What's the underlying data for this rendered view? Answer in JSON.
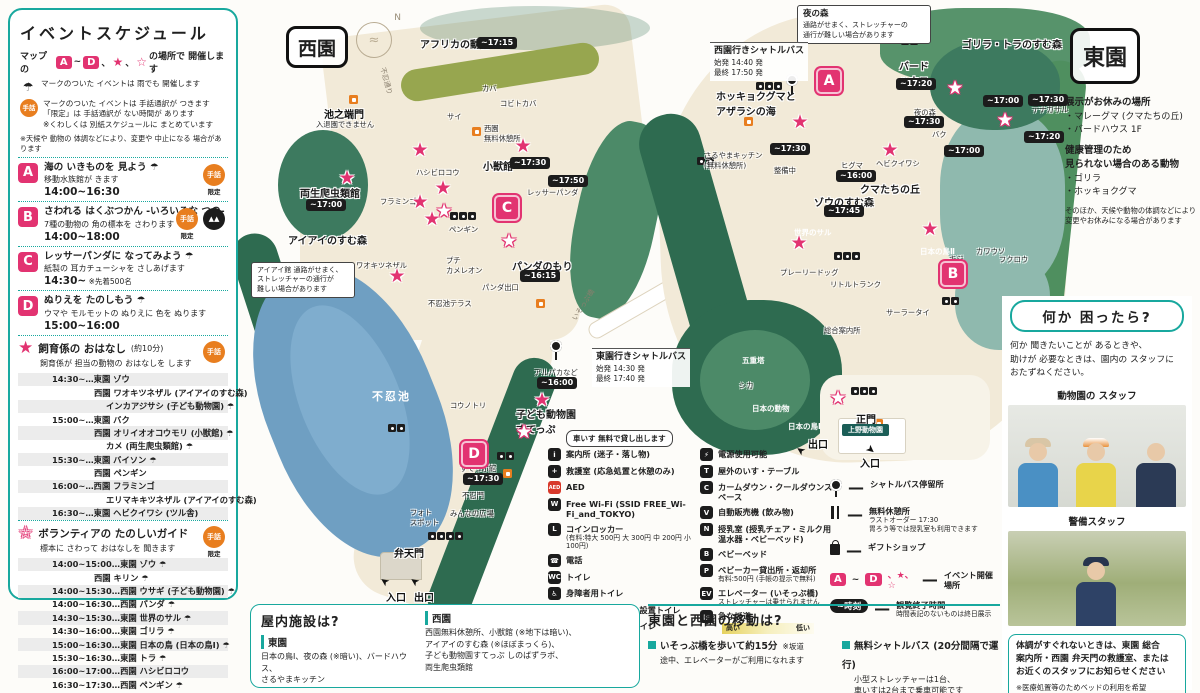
{
  "colors": {
    "teal": "#18a89e",
    "pink": "#e23371",
    "orange": "#e87e1f",
    "chip": "#1c1c1c",
    "pond": "#6f9fc2"
  },
  "icons": {
    "umbrella": "☂",
    "sign": "手話",
    "limited": "限定",
    "star": "★",
    "open_star": "☆",
    "north": "N"
  },
  "left_panel": {
    "title": "イベントスケジュール",
    "intro": {
      "pre": "マップの",
      "a": "A",
      "tilde": "~",
      "d": "D",
      "c1": "、",
      "star": "★",
      "c2": "、",
      "ostar": "☆",
      "post": "の場所で 開催します"
    },
    "note_umbrella": "マークのついた イベントは 雨でも 開催します",
    "note_sign": "マークのついた イベントは 手話通訳が つきます\n「限定」は 手話通訳が ない時間が あります\n※くわしくは 別紙スケジュールに まとめています",
    "disclaimer": "※天候や 動物の 体調などにより、変更や 中止になる 場合があります",
    "events": [
      {
        "letter": "A",
        "title": "海の いきものを 見よう ☂",
        "desc": "移動水族館が きます",
        "time": "14:00~16:30",
        "extra": "",
        "icons": [
          "sign-limited"
        ]
      },
      {
        "letter": "B",
        "title": "さわれる はくぶつかん -いろいろな つの-",
        "desc": "7種の動物の 角の標本を さわります ☂",
        "time": "14:00~18:00",
        "extra": "",
        "icons": [
          "sign-limited",
          "horn-pin"
        ]
      },
      {
        "letter": "C",
        "title": "レッサーパンダに なってみよう ☂",
        "desc": "紙製の 耳カチューシャを さしあげます",
        "time": "14:30~",
        "extra": "※先着500名",
        "icons": []
      },
      {
        "letter": "D",
        "title": "ぬりえを たのしもう ☂",
        "desc": "ウマや モルモットの ぬりえに 色を ぬります",
        "time": "15:00~16:00",
        "extra": "",
        "icons": []
      }
    ],
    "star_section": {
      "glyph": "★",
      "title": "飼育係の おはなし",
      "dur": "(約10分)",
      "desc": "飼育係が 担当の動物の おはなしを します",
      "rows": [
        {
          "t": "14:30~…東園 ゾウ",
          "i": 0
        },
        {
          "t": "西園 ワオキツネザル (アイアイのすむ森)",
          "i": 1
        },
        {
          "t": "インカアジサシ (子ども動物園) ☂",
          "i": 2
        },
        {
          "t": "15:00~…東園 バク",
          "i": 0
        },
        {
          "t": "西園 オリイオオコウモリ (小獣館) ☂",
          "i": 1
        },
        {
          "t": "カメ (両生爬虫類館) ☂",
          "i": 2
        },
        {
          "t": "15:30~…東園 バイソン ☂",
          "i": 0
        },
        {
          "t": "西園 ペンギン",
          "i": 1
        },
        {
          "t": "16:00~…西園 フラミンゴ",
          "i": 0
        },
        {
          "t": "エリマキキツネザル (アイアイのすむ森)",
          "i": 2
        },
        {
          "t": "16:30~…東園 ヘビクイワシ (ツル舎)",
          "i": 0
        }
      ]
    },
    "open_section": {
      "glyph": "☆",
      "title": "ボランティアの たのしいガイド",
      "desc": "標本に さわって おはなしを 聞きます",
      "rows": [
        {
          "t": "14:00~15:00…東園 ゾウ ☂",
          "i": 0
        },
        {
          "t": "西園 キリン ☂",
          "i": 1
        },
        {
          "t": "14:00~15:30…西園 ウサギ (子ども動物園) ☂",
          "i": 0
        },
        {
          "t": "14:00~16:30…西園 パンダ ☂",
          "i": 0
        },
        {
          "t": "14:30~15:30…東園 世界のサル ☂",
          "i": 0
        },
        {
          "t": "14:30~16:00…東園 ゴリラ ☂",
          "i": 0
        },
        {
          "t": "15:00~16:30…東園 日本の鳥 (日本の鳥Ⅰ) ☂",
          "i": 0
        },
        {
          "t": "15:30~16:30…東園 トラ ☂",
          "i": 0
        },
        {
          "t": "16:00~17:00…西園 ハシビロコウ",
          "i": 0
        },
        {
          "t": "16:30~17:30…西園 ペンギン ☂",
          "i": 0
        }
      ]
    }
  },
  "map": {
    "west_label": "西園",
    "east_label": "東園",
    "compass": "N",
    "labels": [
      {
        "t": "アフリカの動物",
        "cls": "area",
        "x": 420,
        "y": 36
      },
      {
        "t": "池之端門",
        "cls": "gate",
        "x": 324,
        "y": 106
      },
      {
        "t": "入退園できません",
        "cls": "tiny",
        "x": 316,
        "y": 120
      },
      {
        "t": "不忍通り",
        "cls": "road",
        "x": 372,
        "y": 76,
        "rot": 75
      },
      {
        "t": "カバ",
        "cls": "tiny",
        "x": 482,
        "y": 84
      },
      {
        "t": "コビトカバ",
        "cls": "tiny",
        "x": 500,
        "y": 99
      },
      {
        "t": "サイ",
        "cls": "tiny",
        "x": 447,
        "y": 112
      },
      {
        "t": "西園\n無料休憩所",
        "cls": "tiny",
        "x": 484,
        "y": 124
      },
      {
        "t": "小獣館",
        "cls": "area",
        "x": 483,
        "y": 158
      },
      {
        "t": "レッサーパンダ",
        "cls": "tiny",
        "x": 527,
        "y": 188
      },
      {
        "t": "ハシビロコウ",
        "cls": "tiny",
        "x": 416,
        "y": 168
      },
      {
        "t": "両生爬虫類館",
        "cls": "area",
        "x": 300,
        "y": 185
      },
      {
        "t": "フラミンゴ",
        "cls": "tiny",
        "x": 380,
        "y": 197
      },
      {
        "t": "アイアイのすむ森",
        "cls": "area",
        "x": 288,
        "y": 232
      },
      {
        "t": "ワオキツネザル",
        "cls": "tiny",
        "x": 356,
        "y": 261
      },
      {
        "t": "ペンギン",
        "cls": "tiny",
        "x": 449,
        "y": 225
      },
      {
        "t": "プチ\nカメレオン",
        "cls": "tiny",
        "x": 446,
        "y": 256
      },
      {
        "t": "パンダのもり",
        "cls": "area",
        "x": 512,
        "y": 258
      },
      {
        "t": "パンダ出口",
        "cls": "tiny",
        "x": 482,
        "y": 283
      },
      {
        "t": "不忍池テラス",
        "cls": "tiny",
        "x": 428,
        "y": 299
      },
      {
        "t": "いそっぷ橋",
        "cls": "road",
        "x": 566,
        "y": 300,
        "rot": -58
      },
      {
        "t": "不忍池",
        "cls": "pond",
        "x": 372,
        "y": 388
      },
      {
        "t": "コウノトリ",
        "cls": "tiny",
        "x": 450,
        "y": 401
      },
      {
        "t": "アルパカなど",
        "cls": "tiny",
        "x": 534,
        "y": 368
      },
      {
        "t": "子ども動物園\nすてっぷ",
        "cls": "area",
        "x": 516,
        "y": 406
      },
      {
        "t": "すてっぷ館",
        "cls": "tiny",
        "x": 460,
        "y": 464
      },
      {
        "t": "不忍門",
        "cls": "tiny",
        "x": 462,
        "y": 491
      },
      {
        "t": "みんなの広場",
        "cls": "tiny",
        "x": 450,
        "y": 509
      },
      {
        "t": "フォト\nスポット",
        "cls": "tiny",
        "x": 410,
        "y": 508
      },
      {
        "t": "弁天門",
        "cls": "gate",
        "x": 394,
        "y": 545
      },
      {
        "t": "入口",
        "cls": "gate",
        "x": 386,
        "y": 589
      },
      {
        "t": "出口",
        "cls": "gate",
        "x": 414,
        "y": 589
      },
      {
        "t": "ゴリラ・トラのすむ森",
        "cls": "area",
        "x": 962,
        "y": 36
      },
      {
        "t": "バード\nハウス",
        "cls": "area",
        "x": 899,
        "y": 58
      },
      {
        "t": "ホッキョクグマと\nアザラシの海",
        "cls": "area",
        "x": 716,
        "y": 88
      },
      {
        "t": "さるやまキッチン\n(無料休憩所)",
        "cls": "tiny",
        "x": 704,
        "y": 151
      },
      {
        "t": "テナガザル",
        "cls": "tiny",
        "x": 1032,
        "y": 105
      },
      {
        "t": "夜の森",
        "cls": "tiny",
        "x": 914,
        "y": 108
      },
      {
        "t": "バク",
        "cls": "tiny",
        "x": 932,
        "y": 130
      },
      {
        "t": "ヘビクイワシ",
        "cls": "tiny",
        "x": 876,
        "y": 159
      },
      {
        "t": "ヒグマ",
        "cls": "tiny",
        "x": 841,
        "y": 161
      },
      {
        "t": "クマたちの丘",
        "cls": "area",
        "x": 860,
        "y": 181
      },
      {
        "t": "ゾウのすむ森",
        "cls": "area",
        "x": 814,
        "y": 194
      },
      {
        "t": "整備中",
        "cls": "tiny",
        "x": 774,
        "y": 166
      },
      {
        "t": "世界のサル",
        "cls": "wdark",
        "x": 794,
        "y": 227
      },
      {
        "t": "プレーリードッグ",
        "cls": "tiny",
        "x": 780,
        "y": 268
      },
      {
        "t": "リトルトランク",
        "cls": "tiny",
        "x": 830,
        "y": 280
      },
      {
        "t": "日本の鳥Ⅱ",
        "cls": "wdark",
        "x": 920,
        "y": 246
      },
      {
        "t": "キジ",
        "cls": "tiny",
        "x": 949,
        "y": 254
      },
      {
        "t": "カワウソ",
        "cls": "tiny",
        "x": 976,
        "y": 247
      },
      {
        "t": "フクロウ",
        "cls": "tiny",
        "x": 999,
        "y": 255
      },
      {
        "t": "サーラータイ",
        "cls": "tiny",
        "x": 886,
        "y": 308
      },
      {
        "t": "総合案内所",
        "cls": "tiny",
        "x": 824,
        "y": 326
      },
      {
        "t": "五重塔",
        "cls": "wdark",
        "x": 742,
        "y": 355
      },
      {
        "t": "シカ",
        "cls": "tiny",
        "x": 739,
        "y": 381
      },
      {
        "t": "日本の動物",
        "cls": "wdark",
        "x": 752,
        "y": 403
      },
      {
        "t": "日本の鳥Ⅰ",
        "cls": "wdark",
        "x": 788,
        "y": 421
      },
      {
        "t": "正門",
        "cls": "gate",
        "x": 856,
        "y": 411
      },
      {
        "t": "上野動物園",
        "cls": "gatesign",
        "x": 842,
        "y": 424
      },
      {
        "t": "出口",
        "cls": "gate",
        "x": 808,
        "y": 436
      },
      {
        "t": "入口",
        "cls": "gate",
        "x": 860,
        "y": 455
      }
    ],
    "chips": [
      {
        "t": "~17:15",
        "x": 477,
        "y": 37
      },
      {
        "t": "~17:30",
        "x": 510,
        "y": 157
      },
      {
        "t": "~17:50",
        "x": 548,
        "y": 175
      },
      {
        "t": "~17:00",
        "x": 306,
        "y": 199
      },
      {
        "t": "~16:15",
        "x": 520,
        "y": 270
      },
      {
        "t": "~16:00",
        "x": 537,
        "y": 377
      },
      {
        "t": "~17:30",
        "x": 463,
        "y": 473
      },
      {
        "t": "~17:20",
        "x": 896,
        "y": 78
      },
      {
        "t": "~17:30",
        "x": 770,
        "y": 143
      },
      {
        "t": "~17:00",
        "x": 983,
        "y": 95
      },
      {
        "t": "~17:30",
        "x": 1028,
        "y": 94
      },
      {
        "t": "~17:20",
        "x": 1024,
        "y": 131
      },
      {
        "t": "~17:30",
        "x": 904,
        "y": 116
      },
      {
        "t": "~17:00",
        "x": 944,
        "y": 145
      },
      {
        "t": "~16:00",
        "x": 836,
        "y": 170
      },
      {
        "t": "~17:45",
        "x": 824,
        "y": 205
      }
    ],
    "markers": [
      {
        "t": "A",
        "x": 816,
        "y": 68
      },
      {
        "t": "B",
        "x": 940,
        "y": 261
      },
      {
        "t": "C",
        "x": 494,
        "y": 195
      },
      {
        "t": "D",
        "x": 461,
        "y": 441
      }
    ],
    "stars_pink": [
      {
        "x": 347,
        "y": 178
      },
      {
        "x": 420,
        "y": 150
      },
      {
        "x": 523,
        "y": 146
      },
      {
        "x": 443,
        "y": 188
      },
      {
        "x": 420,
        "y": 202
      },
      {
        "x": 432,
        "y": 219
      },
      {
        "x": 397,
        "y": 276
      },
      {
        "x": 542,
        "y": 400
      },
      {
        "x": 800,
        "y": 122
      },
      {
        "x": 890,
        "y": 150
      },
      {
        "x": 799,
        "y": 243
      },
      {
        "x": 930,
        "y": 229
      }
    ],
    "stars_white": [
      {
        "x": 444,
        "y": 211
      },
      {
        "x": 509,
        "y": 241
      },
      {
        "x": 524,
        "y": 432
      },
      {
        "x": 955,
        "y": 88
      },
      {
        "x": 1005,
        "y": 120
      },
      {
        "x": 838,
        "y": 398
      }
    ],
    "callouts": [
      {
        "title": "夜の森",
        "body": "通路がせまく、ストレッチャーの\n通行が難しい場合があります",
        "x": 797,
        "y": 5,
        "w": 122
      },
      {
        "title": "",
        "body": "アイアイ館 通路がせまく、\nストレッチャーの通行が\n難しい場合があります",
        "x": 251,
        "y": 262,
        "w": 92
      }
    ],
    "shuttles": [
      {
        "title": "西園行きシャトルバス",
        "lines": "始発 14:40 発\n最終 17:50 発",
        "x": 710,
        "y": 42
      },
      {
        "title": "東園行きシャトルバス",
        "lines": "始発 14:30 発\n最終 17:40 発",
        "x": 592,
        "y": 348
      }
    ],
    "busstops": [
      {
        "x": 786,
        "y": 74
      },
      {
        "x": 550,
        "y": 340
      }
    ],
    "rest_icons": [
      {
        "x": 349,
        "y": 95
      },
      {
        "x": 472,
        "y": 127
      },
      {
        "x": 536,
        "y": 299
      },
      {
        "x": 503,
        "y": 469
      },
      {
        "x": 744,
        "y": 117
      },
      {
        "x": 874,
        "y": 419
      }
    ],
    "clusters": [
      {
        "x": 450,
        "y": 212,
        "n": 3
      },
      {
        "x": 428,
        "y": 532,
        "n": 4
      },
      {
        "x": 497,
        "y": 452,
        "n": 2
      },
      {
        "x": 388,
        "y": 424,
        "n": 2
      },
      {
        "x": 756,
        "y": 82,
        "n": 3
      },
      {
        "x": 901,
        "y": 37,
        "n": 2
      },
      {
        "x": 834,
        "y": 252,
        "n": 3
      },
      {
        "x": 942,
        "y": 297,
        "n": 2
      },
      {
        "x": 851,
        "y": 387,
        "n": 3
      },
      {
        "x": 697,
        "y": 157,
        "n": 2
      }
    ],
    "arrows": [
      {
        "x": 380,
        "y": 575,
        "r": 215
      },
      {
        "x": 410,
        "y": 575,
        "r": 215
      },
      {
        "x": 796,
        "y": 444,
        "r": 215
      },
      {
        "x": 866,
        "y": 443,
        "r": 40
      }
    ]
  },
  "legend": {
    "tooltip": "車いす 無料で貸し出します",
    "col1": [
      {
        "g": "i",
        "label": "案内所 (迷子・落し物)",
        "sub": ""
      },
      {
        "g": "+",
        "label": "救護室 (応急処置と休憩のみ)",
        "sub": ""
      },
      {
        "g": "AED",
        "red": true,
        "label": "AED",
        "sub": ""
      },
      {
        "g": "W",
        "label": "Free Wi-Fi (SSID FREE_Wi-Fi_and_TOKYO)",
        "sub": ""
      },
      {
        "g": "L",
        "label": "コインロッカー",
        "sub": "(有料:特大 500円 大 300円 中 200円 小 100円)"
      },
      {
        "g": "☎",
        "label": "電話",
        "sub": ""
      },
      {
        "g": "WC",
        "label": "トイレ",
        "sub": ""
      },
      {
        "g": "♿",
        "label": "身障者用トイレ",
        "sub": ""
      },
      {
        "g": "U",
        "label": "ユニバーサルシート設置トイレ",
        "sub": ""
      },
      {
        "g": "O",
        "label": "オストメイト対応トイレ",
        "sub": ""
      }
    ],
    "col2": [
      {
        "g": "⚡",
        "label": "電源使用可能",
        "sub": ""
      },
      {
        "g": "T",
        "label": "屋外のいす・テーブル",
        "sub": ""
      },
      {
        "g": "C",
        "label": "カームダウン・クールダウンスペース",
        "sub": ""
      },
      {
        "g": "V",
        "label": "自動販売機 (飲み物)",
        "sub": ""
      },
      {
        "g": "N",
        "label": "授乳室 (授乳チェア・ミルク用温水器・ベビーベッド)",
        "sub": ""
      },
      {
        "g": "B",
        "label": "ベビーベッド",
        "sub": ""
      },
      {
        "g": "P",
        "label": "ベビーカー貸出所・返却所",
        "sub": "有料:500円 (手帳の提示で無料)"
      },
      {
        "g": "EV",
        "label": "エレベーター (いそっぷ橋)",
        "sub": "ストレッチャーは乗せられません"
      },
      {
        "g": "▨",
        "label": "急な坂道",
        "sub": "",
        "slope": true,
        "high": "高い",
        "low": "低い"
      }
    ],
    "col3_busstop": "シャトルバス停留所",
    "col3_rest": "無料休憩所",
    "col3_rest_sub": "ラストオーダー 17:30\n胃ろう等では授乳室も利用できます",
    "col3_gift": "ギフトショップ",
    "col3_events": {
      "a": "A",
      "tilde": "~",
      "d": "D",
      "stars": "、★、☆",
      "dash": "—",
      "label": "イベント開催場所"
    },
    "col3_time": {
      "chip": "~時刻",
      "dash": "—",
      "label": "観覧終了時間",
      "sub": "時間表記のないものは終日展示"
    }
  },
  "bottom": {
    "indoor": {
      "title": "屋内施設は?",
      "east_h": "東園",
      "east": "日本の鳥Ⅰ、夜の森 (※暗い)、バードハウス、\nさるやまキッチン",
      "west_h": "西園",
      "west": "西園無料休憩所、小獣館 (※地下は暗い)、\nアイアイのすむ森 (※ほぼまっくら)、\n子ども動物園すてっぷ しのばずラボ、\n両生爬虫類館"
    },
    "transfer": {
      "title": "東園と西園の移動は?",
      "item1": "いそっぷ橋を歩いて約15分",
      "item1_note": "※坂道",
      "item1_sub": "途中、エレベーターがご利用になれます",
      "item2": "無料シャトルバス (20分間隔で運行)",
      "item2_sub": "小型ストレッチャーは1台、\n車いすは2台まで乗車可能です"
    }
  },
  "right": {
    "east_box": "東園",
    "closed_title": "展示がお休みの場所",
    "closed": [
      "・マレーグマ (クマたちの丘)",
      "・バードハウス 1F"
    ],
    "health_title": "健康管理のため\n見られない場合のある動物",
    "health": [
      "・ゴリラ",
      "・ホッキョクグマ"
    ],
    "note": "そのほか、天候や動物の体調などにより\n変更やお休みになる場合があります",
    "help": {
      "title": "何か 困ったら?",
      "body": "何か 聞きたいことが あるときや、\n助けが 必要なときは、園内の スタッフに\nおたずねください。",
      "staff1": "動物園の スタッフ",
      "staff2": "警備スタッフ",
      "notice": "体調がすぐれないときは、東園 総合\n案内所・西園 弁天門の救護室、または\nお近くのスタッフにお知らせください",
      "notice_sub": "※医療処置等のためベッドの利用を希望\nされる方はスタッフにお知らせください"
    }
  }
}
